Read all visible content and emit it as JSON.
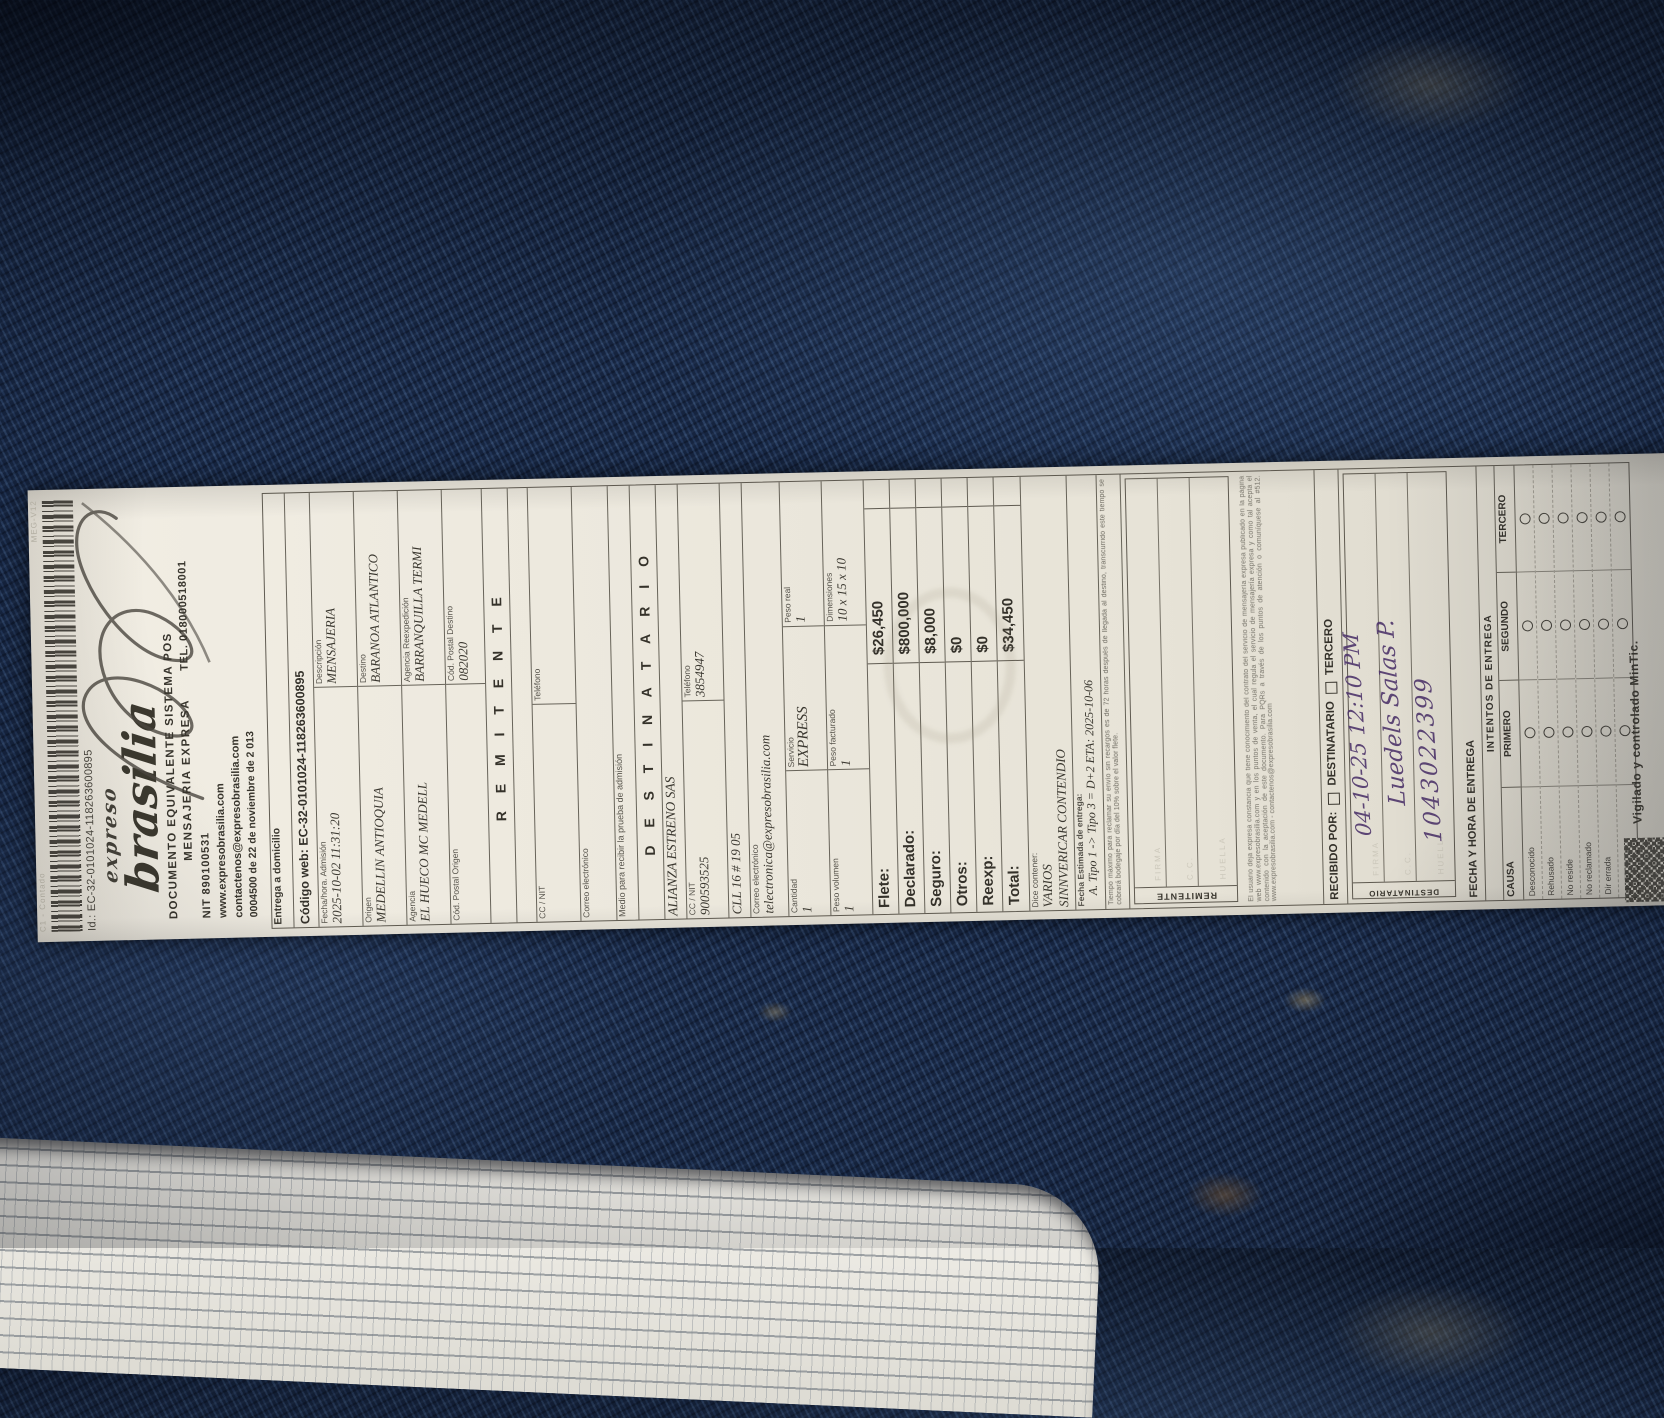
{
  "colors": {
    "fabric": "#1c2e4e",
    "paper": "#ece8dd",
    "ink": "#3e3b33",
    "handwriting": "#4e356b"
  },
  "receipt": {
    "edge": {
      "left": "C1 - Contado",
      "right": "MEG-V12"
    },
    "barcode_label": "Id.: EC-32-0101024-118263600895",
    "logo": {
      "top": "expreso",
      "main": "brasilia"
    },
    "header": {
      "line1": "DOCUMENTO EQUIVALENTE SISTEMA POS",
      "line2": "MENSAJERIA EXPRESA",
      "tel": "TEL. 018000518001",
      "nit": "NIT 890100531",
      "web": "www.expresobrasilia.com",
      "email": "contactenos@expresobrasilia.com",
      "auth": "0004500 de 22 de noviembre de 2 013"
    },
    "form": {
      "delivery": "Entrega a domicilio",
      "codigo_web": "Código web: EC-32-0101024-118263600895",
      "info_rows": [
        {
          "l_label": "Fecha/hora. Admisión",
          "l_value": "2025-10-02 11:31:20",
          "r_label": "Descripción",
          "r_value": "MENSAJERIA"
        },
        {
          "l_label": "Origen",
          "l_value": "MEDELLIN ANTIOQUIA",
          "r_label": "Destino",
          "r_value": "BARANOA ATLANTICO"
        },
        {
          "l_label": "Agencia",
          "l_value": "EL HUECO MC MEDELL",
          "r_label": "Agencia Reexpedición",
          "r_value": "BARRANQUILLA TERMI"
        },
        {
          "l_label": "Cód. Postal Origen",
          "l_value": "",
          "r_label": "Cód. Postal Destino",
          "r_value": "082020"
        }
      ],
      "remitente": {
        "title": "R E M I T E N T E",
        "cc_label": "CC / NIT",
        "cc_value": "",
        "tel_label": "Teléfono",
        "tel_value": "",
        "email_label": "Correo electrónico",
        "email_value": "",
        "medio": "Medio para recibir la prueba de admisión"
      },
      "destinatario": {
        "title": "D E S T I N A T A R I O",
        "name": "ALIANZA ESTRENO SAS",
        "cc_label": "CC / NIT",
        "cc_value": "900593525",
        "tel_label": "Teléfono",
        "tel_value": "3854947",
        "address": "CLL 16 # 19 05",
        "email_label": "Correo electrónico",
        "email_value": "telectronica@expresobrasilia.com"
      },
      "cargo": {
        "row1": [
          {
            "label": "Cantidad",
            "value": "1"
          },
          {
            "label": "Servicio",
            "value": "EXPRESS"
          },
          {
            "label": "Peso real",
            "value": "1"
          }
        ],
        "row2": [
          {
            "label": "Peso volumen",
            "value": "1"
          },
          {
            "label": "Peso facturado",
            "value": "1"
          },
          {
            "label": "Dimensiones",
            "value": "10 x 15 x 10"
          }
        ]
      },
      "totals": [
        {
          "label": "Flete:",
          "value": "$26,450"
        },
        {
          "label": "Declarado:",
          "value": "$800,000"
        },
        {
          "label": "Seguro:",
          "value": "$8,000"
        },
        {
          "label": "Otros:",
          "value": "$0"
        },
        {
          "label": "Reexp:",
          "value": "$0"
        },
        {
          "label": "Total:",
          "value": "$34,450"
        }
      ],
      "contents": {
        "label": "Dice contener:",
        "value1": "VARIOS",
        "value2": "SINNVERICAR CONTENDIO"
      },
      "eta": {
        "label": "Fecha Estimada de entrega:",
        "value": "A. Tipo 1 -> Tipo 3 = D+2 ETA: 2025-10-06"
      },
      "note_storage": "Tiempo máximo para reclamar su envío sin recargos es de 72 horas después de llegada al destino, transcurrido este tiempo se cobrará bodegaje por día del 10% sobre el valor flete.",
      "sig_remitente": {
        "side": "REMITENTE",
        "rows": [
          "FIRMA",
          "C.C.",
          "HUELLA"
        ]
      },
      "legal": "El usuario deja expresa constancia que tiene conocimiento del contrato del servicio de mensajería expresa publicado en la página web www.expresobrasilia.com y en los puntos de venta, el cual regula el servicio de mensajería expresa y como tal acepta el contenido con la aceptación de este documento. Para PQRs a través de los puntos de atención o comuníquese al #512. www.expresobrasilia.com - contactenos@expresobrasilia.com",
      "recibido": {
        "label": "RECIBIDO POR:",
        "opt1": "DESTINATARIO",
        "opt2": "TERCERO"
      },
      "sig_destinatario": {
        "side": "DESTINATARIO",
        "rows": [
          "FIRMA",
          "C.C.",
          "HUELLA"
        ],
        "handwriting": [
          "04-10-25   12:10 PM",
          "Luedels Salas P.",
          "1043022399"
        ]
      },
      "fecha_entrega_label": "FECHA Y HORA DE ENTREGA",
      "intentos": {
        "title": "INTENTOS DE ENTREGA",
        "causa_label": "CAUSA",
        "cols": [
          "PRIMERO",
          "SEGUNDO",
          "TERCERO"
        ],
        "causas": [
          "Desconocido",
          "Rehusado",
          "No reside",
          "No reclamado",
          "Dir errada",
          "Otros"
        ]
      },
      "footer": "Vigilado y controlado MinTic."
    }
  }
}
